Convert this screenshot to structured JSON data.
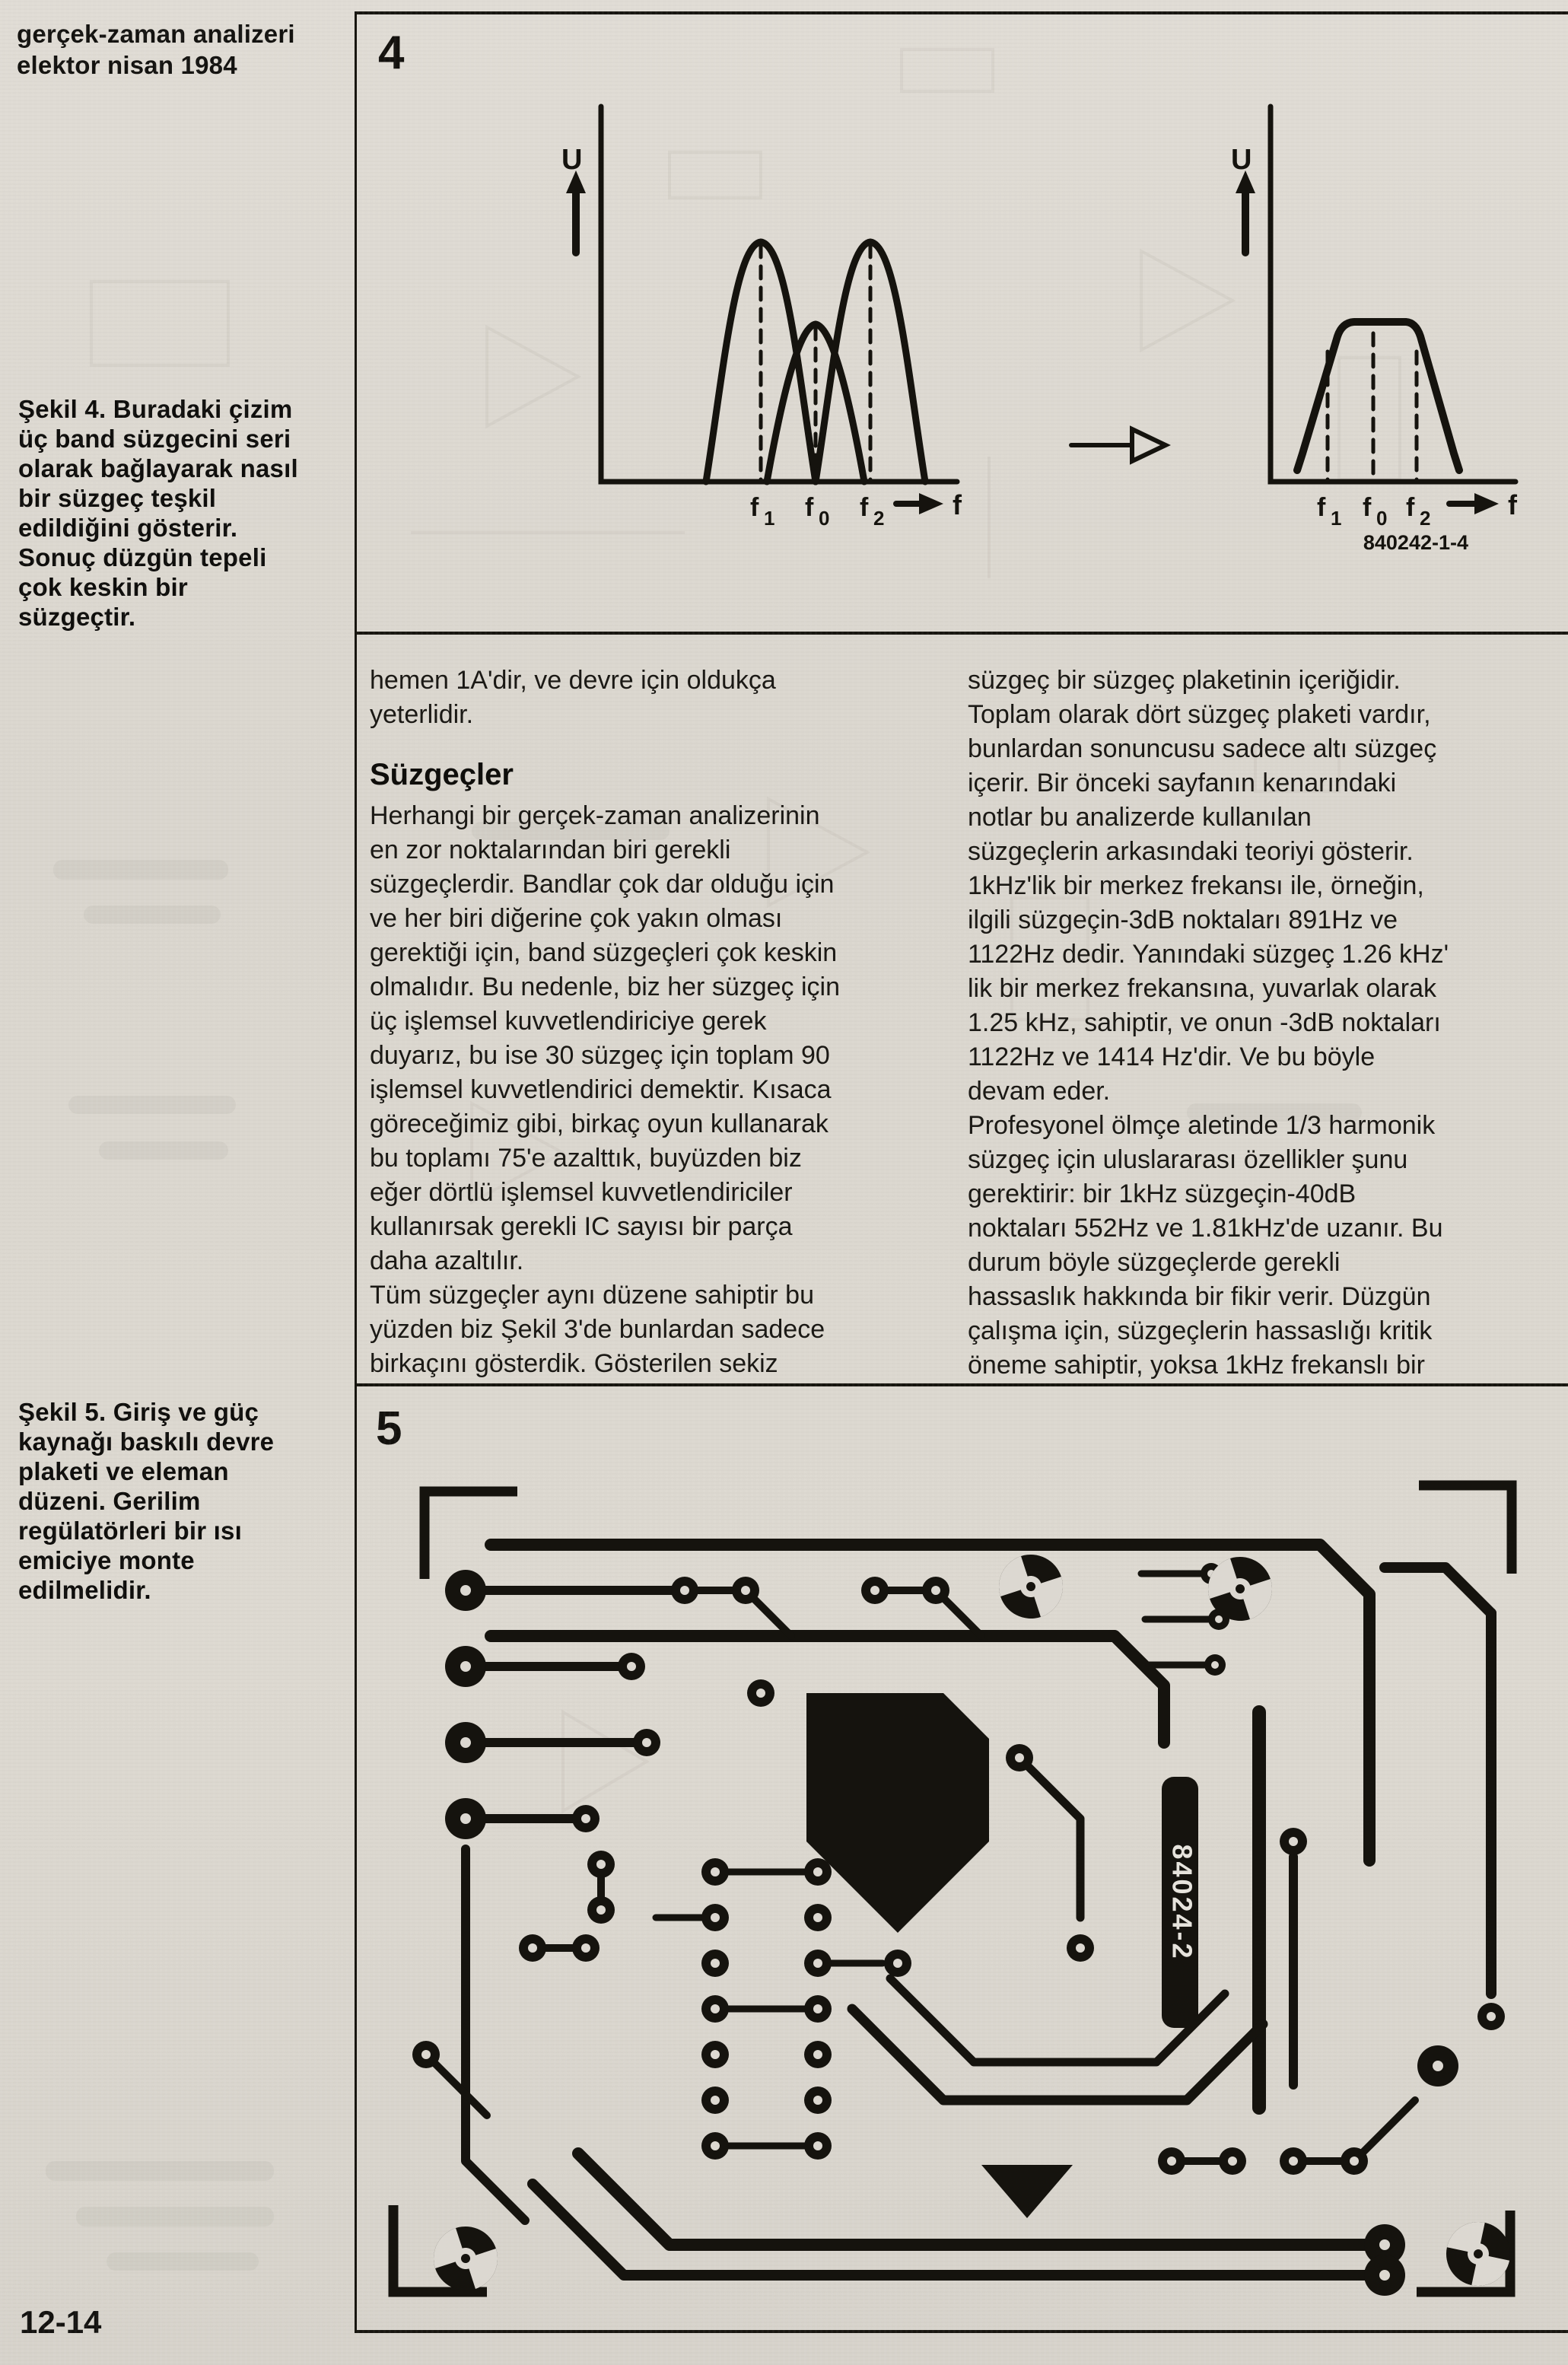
{
  "page": {
    "header": {
      "line1": "gerçek-zaman analizeri",
      "line2": "elektor nisan 1984"
    },
    "page_number": "12-14"
  },
  "figure4": {
    "number": "4",
    "caption": "Şekil 4. Buradaki çizim\nüç band süzgecini seri\nolarak bağlayarak nasıl\nbir süzgeç teşkil\nedildiğini gösterir.\nSonuç düzgün tepeli\nçok keskin bir\nsüzgeçtir.",
    "code": "840242-1-4",
    "axis_u": "U",
    "axis_f": "f",
    "ticks": [
      {
        "base": "f",
        "sub": "1"
      },
      {
        "base": "f",
        "sub": "0"
      },
      {
        "base": "f",
        "sub": "2"
      }
    ]
  },
  "figure5": {
    "number": "5",
    "caption": "Şekil 5. Giriş ve güç\nkaynağı baskılı devre\nplaketi ve eleman\ndüzeni. Gerilim\nregülatörleri bir ısı\nemiciye monte\nedilmelidir.",
    "pcb_code": "84024-2"
  },
  "columns": {
    "left": [
      {
        "style": "body",
        "text": "hemen 1A'dir, ve devre için oldukça\nyeterlidir."
      },
      {
        "style": "heading",
        "text": "Süzgeçler"
      },
      {
        "style": "body",
        "text": "Herhangi bir gerçek-zaman analizerinin\nen zor noktalarından biri gerekli\nsüzgeçlerdir. Bandlar çok dar olduğu için\nve her biri diğerine çok yakın olması\ngerektiği için, band süzgeçleri çok keskin\nolmalıdır. Bu nedenle, biz her süzgeç için\nüç işlemsel kuvvetlendiriciye gerek\nduyarız, bu ise 30 süzgeç için toplam 90\nişlemsel kuvvetlendirici demektir. Kısaca\ngöreceğimiz gibi, birkaç oyun kullanarak\nbu toplamı 75'e azalttık, buyüzden biz\neğer dörtlü işlemsel kuvvetlendiriciler\nkullanırsak gerekli IC sayısı bir parça\ndaha azaltılır."
      },
      {
        "style": "body",
        "text": "Tüm süzgeçler aynı düzene sahiptir bu\nyüzden biz Şekil 3'de bunlardan sadece\nbirkaçını gösterdik. Gösterilen sekiz"
      }
    ],
    "right": [
      {
        "style": "body",
        "text": "süzgeç bir süzgeç plaketinin içeriğidir.\nToplam olarak dört süzgeç plaketi vardır,\nbunlardan sonuncusu sadece altı süzgeç\niçerir. Bir önceki sayfanın kenarındaki\nnotlar bu analizerde kullanılan\nsüzgeçlerin arkasındaki teoriyi gösterir.\n1kHz'lik bir merkez frekansı ile, örneğin,\nilgili süzgeçin-3dB noktaları 891Hz ve\n1122Hz dedir. Yanındaki süzgeç 1.26 kHz'\nlik bir merkez frekansına, yuvarlak olarak\n1.25 kHz, sahiptir, ve onun -3dB noktaları\n1122Hz ve 1414 Hz'dir. Ve bu böyle\ndevam eder."
      },
      {
        "style": "body",
        "text": "Profesyonel ölmçe aletinde 1/3 harmonik\nsüzgeç için uluslararası özellikler şunu\ngerektirir: bir 1kHz süzgeçin-40dB\nnoktaları 552Hz ve 1.81kHz'de uzanır. Bu\ndurum böyle süzgeçlerde gerekli\nhassaslık hakkında bir fikir verir. Düzgün\nçalışma için, süzgeçlerin hassaslığı kritik\nöneme sahiptir, yoksa 1kHz frekanslı bir"
      }
    ]
  }
}
